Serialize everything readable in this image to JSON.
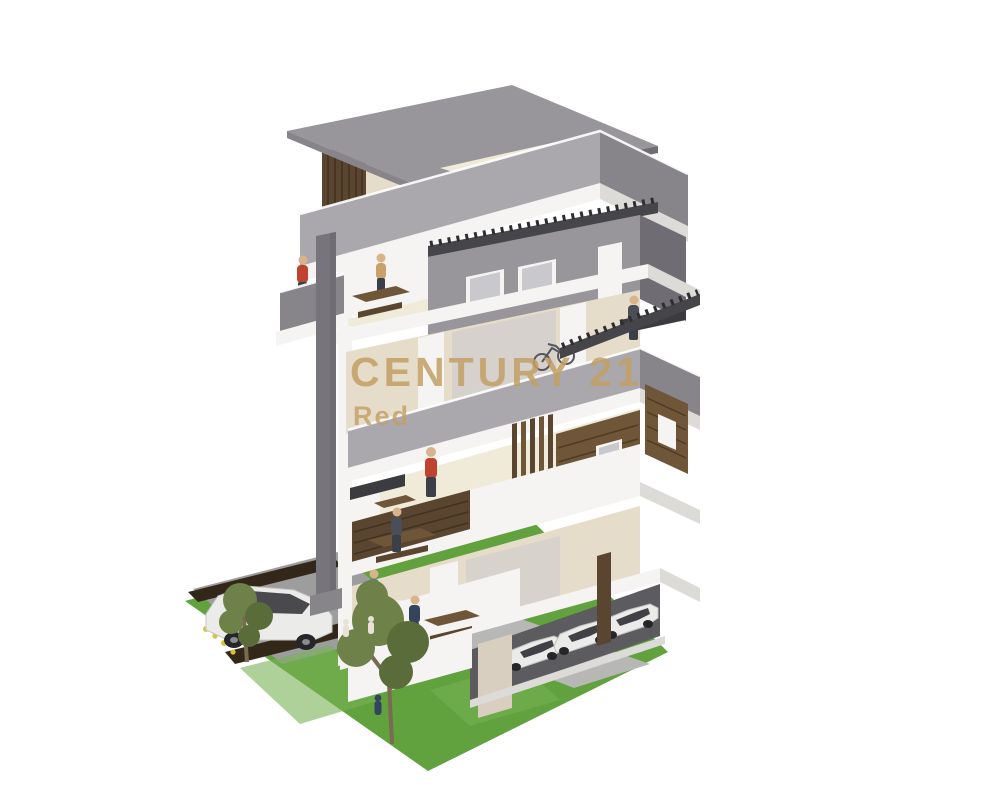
{
  "watermark": {
    "line1": "CENTURY 21",
    "line2": "Red"
  },
  "scene": {
    "type": "3d-architectural-rendering",
    "subject": "Cutaway render of a modern multi-storey apartment building",
    "floors_visible": 5,
    "penthouse_with_flat_roof": true,
    "roof_terrace": true,
    "garage_cars": 3,
    "driveway_cars": 1,
    "trees": 2,
    "people_figures": 11,
    "background": "#ffffff"
  },
  "colors": {
    "roof_gray": "#98969b",
    "wall_gray": "#aaa8ad",
    "wall_gray_dark": "#87858a",
    "wall_gray_darker": "#6f6d73",
    "cream": "#e6dcca",
    "cream_light": "#f0ead9",
    "cream_dark": "#d8cfc0",
    "slab_white": "#f5f4f2",
    "slab_shadow": "#dcdbd8",
    "wood_dark": "#5a4530",
    "wood_mid": "#6f5639",
    "wood_light": "#8a6b47",
    "beam_dark": "#45454a",
    "column_gray": "#77757b",
    "glass_gray": "#c9c8cd",
    "lawn_green": "#61a13e",
    "lawn_light": "#78b355",
    "drive_gray": "#9d9d9e",
    "path_light": "#b7b7b6",
    "soil_dark": "#33271a",
    "tree_olive": "#6e8148",
    "tree_olive_dark": "#5a6c3a",
    "trunk_brown": "#7a6a52",
    "car_white": "#ebebea",
    "car_glass": "#2e2e33",
    "garage_dark": "#5c5b5f",
    "person_red": "#c0432f",
    "person_blue": "#5b7ea0",
    "person_navy": "#33445c",
    "person_tan": "#c9a06b",
    "person_dark": "#4a4f57",
    "person_skin": "#d9b38c",
    "person_legs": "#3a3f48",
    "flower_yellow": "#d9c33a",
    "watermark_gold": "#c2a065"
  }
}
